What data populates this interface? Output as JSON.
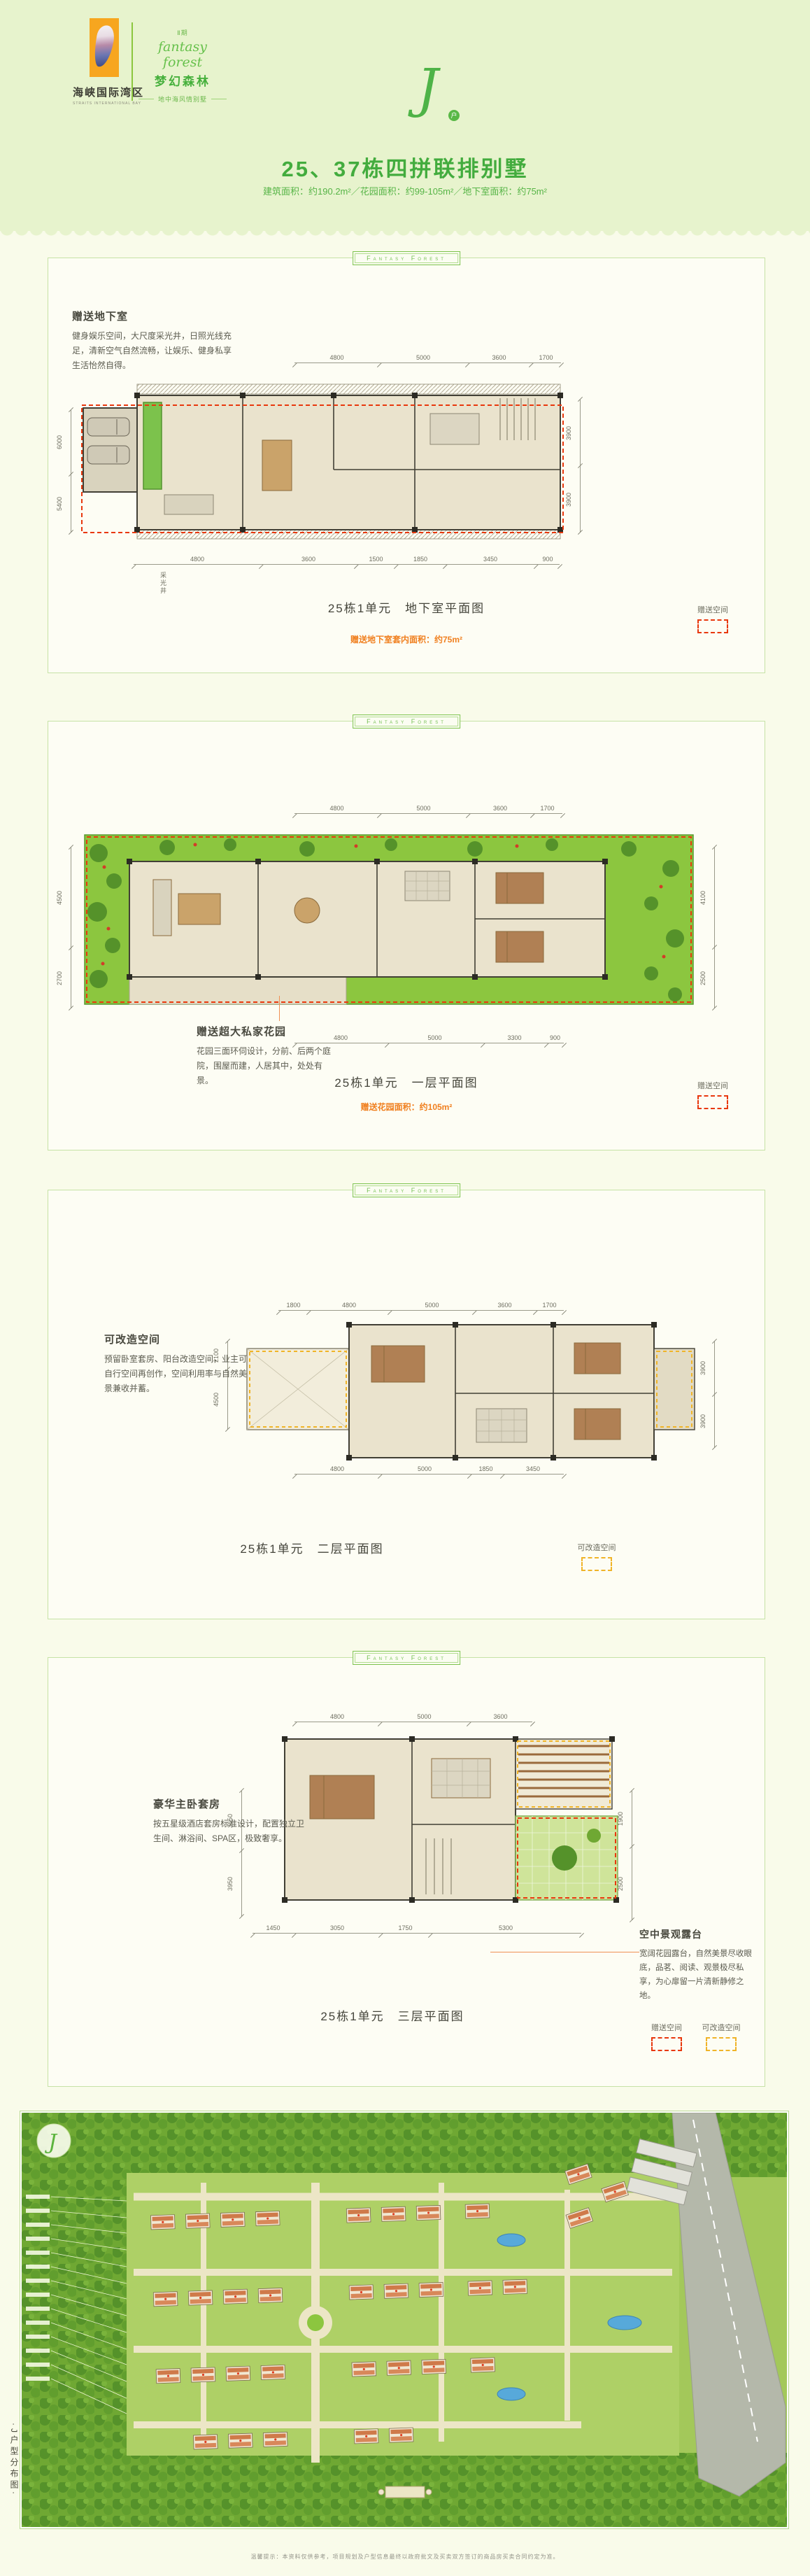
{
  "header": {
    "logo_name": "海峡国际湾区",
    "logo_en": "STRAITS INTERNATIONAL BAY",
    "phase": "Ⅱ期",
    "script": "fantasy forest",
    "brand": "梦幻森林",
    "tagline": "地中海风情别墅",
    "monogram": "J",
    "monogram_badge": "户",
    "title": "25、37栋四拼联排别墅",
    "subtitle": "建筑面积：约190.2m²／花园面积：约99-105m²／地下室面积：约75m²"
  },
  "ribbon": "Fantasy Forest",
  "legend": {
    "gift": "赠送空间",
    "convert": "可改造空间"
  },
  "colors": {
    "accent_green": "#46b03c",
    "note_orange": "#f07f1e",
    "gift_dash_red": "#e8380d",
    "convert_dash_yellow": "#f0b428",
    "logo_orange": "#f7a61f"
  },
  "panels": [
    {
      "feature_title": "赠送地下室",
      "feature_body": "健身娱乐空间，大尺度采光井，日照光线充足，清新空气自然流畅，让娱乐、健身私享生活怡然自得。",
      "plan_label": "采光井",
      "caption": "25栋1单元　地下室平面图",
      "note": "赠送地下室套内面积：约75m²",
      "dims_top": [
        "4800",
        "5000",
        "3600",
        "1700"
      ],
      "dims_bottom": [
        "4800",
        "3600",
        "1500",
        "1850",
        "3450",
        "900"
      ],
      "dims_left": [
        "6000",
        "5400"
      ],
      "dims_right": [
        "3900",
        "3900"
      ]
    },
    {
      "feature_title": "赠送超大私家花园",
      "feature_body": "花园三面环伺设计，分前、后两个庭院，围屋而建，人居其中，处处有景。",
      "caption": "25栋1单元　一层平面图",
      "note": "赠送花园面积：约105m²",
      "dims_top": [
        "4800",
        "5000",
        "3600",
        "1700"
      ],
      "dims_bottom": [
        "4800",
        "5000",
        "3300",
        "900"
      ],
      "dims_left": [
        "4500",
        "2700"
      ],
      "dims_right": [
        "4100",
        "2500"
      ]
    },
    {
      "feature_title": "可改造空间",
      "feature_body": "预留卧室套房、阳台改造空间，业主可自行空间再创作，空间利用率与自然美景兼收并蓄。",
      "caption": "25栋1单元　二层平面图",
      "dims_top": [
        "1800",
        "4800",
        "5000",
        "3600",
        "1700"
      ],
      "dims_bottom": [
        "4800",
        "5000",
        "1850",
        "3450"
      ],
      "dims_left": [
        "2100",
        "4500"
      ],
      "dims_right": [
        "3900",
        "3900"
      ]
    },
    {
      "feature_title": "豪华主卧套房",
      "feature_body": "按五星级酒店套房标准设计，配置独立卫生间、淋浴间、SPA区，极致奢享。",
      "terrace_title": "空中景观露台",
      "terrace_body": "宽阔花园露台，自然美景尽收眼底，品茗、阅读、观景极尽私享，为心扉留一片清新静修之地。",
      "caption": "25栋1单元　三层平面图",
      "dims_top": [
        "4800",
        "5000",
        "3600"
      ],
      "dims_bottom": [
        "1450",
        "3050",
        "1750",
        "5300"
      ],
      "dims_left": [
        "3650",
        "3950"
      ],
      "dims_right": [
        "1900",
        "2500"
      ]
    }
  ],
  "siteplan": {
    "monogram": "J",
    "side_caption": "·J户型分布图·",
    "disclaimer": "温馨提示：本资料仅供参考，项目规划及户型信息最终以政府批文及买卖双方签订的商品房买卖合同约定为准。"
  }
}
